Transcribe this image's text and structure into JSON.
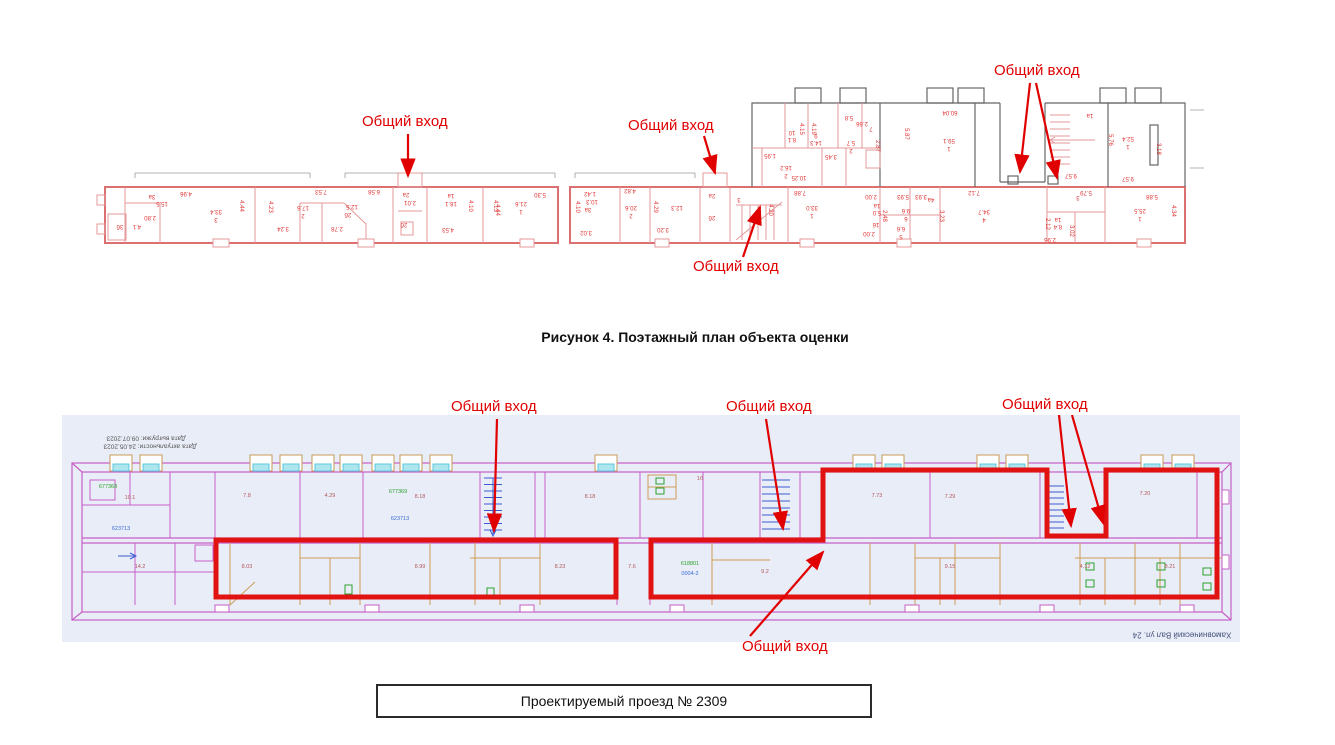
{
  "figure_caption": "Рисунок 4. Поэтажный план объекта оценки",
  "road_box": {
    "label": "Проектируемый проезд № 2309"
  },
  "colors": {
    "entrance_red": "#e00000",
    "highlight_red": "#e11212",
    "plan_pink": "#e49a9a",
    "plan_magenta": "#c75fc7",
    "partition_orange": "#cf9a55",
    "window_cyan": "#aee6f0",
    "stair_blue": "#3a5bd0",
    "bg_blue": "#e9edf8",
    "code_green": "#2ba12b",
    "code_blue": "#3a6bd6"
  },
  "top_plan": {
    "entrances": [
      {
        "text": "Общий вход",
        "x": 362,
        "y": 113,
        "arrows": [
          [
            408,
            134,
            408,
            176
          ]
        ]
      },
      {
        "text": "Общий вход",
        "x": 628,
        "y": 117,
        "arrows": [
          [
            704,
            136,
            715,
            173
          ]
        ]
      },
      {
        "text": "Общий вход",
        "x": 693,
        "y": 258,
        "arrows": [
          [
            743,
            257,
            760,
            207
          ]
        ]
      },
      {
        "text": "Общий вход",
        "x": 994,
        "y": 62,
        "arrows": [
          [
            1030,
            83,
            1020,
            172
          ],
          [
            1036,
            83,
            1057,
            178
          ]
        ]
      }
    ],
    "dim_labels": [
      {
        "t": "4.96",
        "x": 186,
        "y": 193
      },
      {
        "t": "3а",
        "x": 152,
        "y": 196
      },
      {
        "t": "15.5",
        "x": 162,
        "y": 203
      },
      {
        "t": "2.80",
        "x": 150,
        "y": 217
      },
      {
        "t": "4.1",
        "x": 137,
        "y": 226
      },
      {
        "t": "3б",
        "x": 120,
        "y": 226
      },
      {
        "t": "33.4",
        "x": 216,
        "y": 211
      },
      {
        "t": "3",
        "x": 216,
        "y": 219
      },
      {
        "t": "7.53",
        "x": 321,
        "y": 191
      },
      {
        "t": "4.44",
        "x": 241,
        "y": 206,
        "v": 1
      },
      {
        "t": "17.6",
        "x": 303,
        "y": 207
      },
      {
        "t": "2",
        "x": 303,
        "y": 215
      },
      {
        "t": "3.24",
        "x": 283,
        "y": 228
      },
      {
        "t": "2.78",
        "x": 337,
        "y": 228
      },
      {
        "t": "12.5",
        "x": 352,
        "y": 206
      },
      {
        "t": "2б",
        "x": 348,
        "y": 214
      },
      {
        "t": "6.58",
        "x": 374,
        "y": 191
      },
      {
        "t": "4.23",
        "x": 270,
        "y": 207,
        "v": 1
      },
      {
        "t": "4.44",
        "x": 497,
        "y": 210,
        "v": 1
      },
      {
        "t": "2а",
        "x": 406,
        "y": 194
      },
      {
        "t": "2.01",
        "x": 410,
        "y": 202
      },
      {
        "t": "2б",
        "x": 404,
        "y": 224
      },
      {
        "t": "1а",
        "x": 451,
        "y": 195
      },
      {
        "t": "18.1",
        "x": 451,
        "y": 203
      },
      {
        "t": "4.10",
        "x": 470,
        "y": 206,
        "v": 1
      },
      {
        "t": "4.53",
        "x": 448,
        "y": 229
      },
      {
        "t": "4.13",
        "x": 495,
        "y": 206,
        "v": 1
      },
      {
        "t": "21.6",
        "x": 521,
        "y": 203
      },
      {
        "t": "1",
        "x": 521,
        "y": 211
      },
      {
        "t": "5.30",
        "x": 540,
        "y": 194
      },
      {
        "t": "4.10",
        "x": 577,
        "y": 207,
        "v": 1
      },
      {
        "t": "1.42",
        "x": 590,
        "y": 193
      },
      {
        "t": "10.3",
        "x": 592,
        "y": 201
      },
      {
        "t": "3а",
        "x": 588,
        "y": 209
      },
      {
        "t": "3.02",
        "x": 586,
        "y": 232
      },
      {
        "t": "4.82",
        "x": 630,
        "y": 190
      },
      {
        "t": "20.6",
        "x": 631,
        "y": 207
      },
      {
        "t": "2",
        "x": 631,
        "y": 215
      },
      {
        "t": "4.29",
        "x": 655,
        "y": 207,
        "v": 1
      },
      {
        "t": "12.3",
        "x": 677,
        "y": 207
      },
      {
        "t": "3.20",
        "x": 663,
        "y": 229
      },
      {
        "t": "2а",
        "x": 712,
        "y": 195
      },
      {
        "t": "2б",
        "x": 712,
        "y": 217
      },
      {
        "t": "3",
        "x": 739,
        "y": 199
      },
      {
        "t": "7.88",
        "x": 800,
        "y": 192
      },
      {
        "t": "33.0",
        "x": 812,
        "y": 207
      },
      {
        "t": "1",
        "x": 812,
        "y": 215
      },
      {
        "t": "4.20",
        "x": 770,
        "y": 210,
        "v": 1
      },
      {
        "t": "2.00",
        "x": 871,
        "y": 196
      },
      {
        "t": "1а",
        "x": 877,
        "y": 205
      },
      {
        "t": "5.0",
        "x": 877,
        "y": 212
      },
      {
        "t": "16",
        "x": 876,
        "y": 224
      },
      {
        "t": "2.00",
        "x": 869,
        "y": 233
      },
      {
        "t": "5.93",
        "x": 903,
        "y": 196
      },
      {
        "t": "3.93",
        "x": 921,
        "y": 196
      },
      {
        "t": "4а",
        "x": 931,
        "y": 199
      },
      {
        "t": "2.48",
        "x": 884,
        "y": 216,
        "v": 1
      },
      {
        "t": "9.6",
        "x": 906,
        "y": 210
      },
      {
        "t": "6",
        "x": 906,
        "y": 218
      },
      {
        "t": "6.6",
        "x": 901,
        "y": 228
      },
      {
        "t": "5",
        "x": 901,
        "y": 236
      },
      {
        "t": "3.23",
        "x": 941,
        "y": 216,
        "v": 1
      },
      {
        "t": "7.12",
        "x": 974,
        "y": 192
      },
      {
        "t": "34.7",
        "x": 984,
        "y": 211
      },
      {
        "t": "4",
        "x": 984,
        "y": 219
      },
      {
        "t": "2.12",
        "x": 1047,
        "y": 224,
        "v": 1
      },
      {
        "t": "3",
        "x": 1078,
        "y": 197
      },
      {
        "t": "5.79",
        "x": 1086,
        "y": 192
      },
      {
        "t": "1а",
        "x": 1058,
        "y": 219
      },
      {
        "t": "8.4",
        "x": 1058,
        "y": 226
      },
      {
        "t": "3.02",
        "x": 1071,
        "y": 231,
        "v": 1
      },
      {
        "t": "2.96",
        "x": 1050,
        "y": 239
      },
      {
        "t": "5.88",
        "x": 1152,
        "y": 196
      },
      {
        "t": "25.5",
        "x": 1140,
        "y": 210
      },
      {
        "t": "1",
        "x": 1140,
        "y": 218
      },
      {
        "t": "4.34",
        "x": 1173,
        "y": 211,
        "v": 1
      },
      {
        "t": "1.95",
        "x": 770,
        "y": 155
      },
      {
        "t": "16.2",
        "x": 786,
        "y": 167
      },
      {
        "t": "2",
        "x": 786,
        "y": 175
      },
      {
        "t": "10.25",
        "x": 799,
        "y": 177
      },
      {
        "t": "10",
        "x": 792,
        "y": 132
      },
      {
        "t": "8.1",
        "x": 792,
        "y": 139
      },
      {
        "t": "9",
        "x": 816,
        "y": 135
      },
      {
        "t": "14.3",
        "x": 816,
        "y": 142
      },
      {
        "t": "4.15",
        "x": 801,
        "y": 129,
        "v": 1
      },
      {
        "t": "4.19",
        "x": 813,
        "y": 129,
        "v": 1
      },
      {
        "t": "3.45",
        "x": 831,
        "y": 156
      },
      {
        "t": "5.8",
        "x": 849,
        "y": 117
      },
      {
        "t": "2.66",
        "x": 862,
        "y": 123
      },
      {
        "t": "7",
        "x": 871,
        "y": 128
      },
      {
        "t": "5.7",
        "x": 851,
        "y": 142
      },
      {
        "t": "2",
        "x": 851,
        "y": 150
      },
      {
        "t": "2.87",
        "x": 877,
        "y": 146,
        "v": 1
      },
      {
        "t": "5.87",
        "x": 906,
        "y": 134,
        "v": 1
      },
      {
        "t": "60.04",
        "x": 950,
        "y": 112
      },
      {
        "t": "59.1",
        "x": 949,
        "y": 140
      },
      {
        "t": "1",
        "x": 949,
        "y": 148
      },
      {
        "t": "9.57",
        "x": 1071,
        "y": 175
      },
      {
        "t": "1а",
        "x": 1090,
        "y": 115
      },
      {
        "t": "5.76",
        "x": 1110,
        "y": 140,
        "v": 1
      },
      {
        "t": "52.4",
        "x": 1128,
        "y": 138
      },
      {
        "t": "1",
        "x": 1128,
        "y": 146
      },
      {
        "t": "3.18",
        "x": 1158,
        "y": 149,
        "v": 1
      },
      {
        "t": "9.57",
        "x": 1128,
        "y": 178
      }
    ]
  },
  "bottom_plan": {
    "entrances": [
      {
        "text": "Общий вход",
        "x": 451,
        "y": 398,
        "arrows": [
          [
            497,
            419,
            494,
            531
          ]
        ]
      },
      {
        "text": "Общий вход",
        "x": 726,
        "y": 398,
        "arrows": [
          [
            766,
            419,
            783,
            529
          ]
        ]
      },
      {
        "text": "Общий вход",
        "x": 1002,
        "y": 396,
        "arrows": [
          [
            1059,
            415,
            1071,
            526
          ],
          [
            1072,
            415,
            1103,
            523
          ]
        ]
      },
      {
        "text": "Общий вход",
        "x": 742,
        "y": 638,
        "arrows": [
          [
            750,
            636,
            823,
            552
          ]
        ]
      }
    ],
    "window_x": [
      110,
      140,
      250,
      280,
      312,
      340,
      372,
      400,
      430,
      595,
      853,
      882,
      977,
      1006,
      1141,
      1172
    ],
    "labels": [
      {
        "t": "677368",
        "x": 108,
        "y": 487,
        "c": "#2ba12b",
        "n": "code-label"
      },
      {
        "t": "623713",
        "x": 121,
        "y": 529,
        "c": "#3a6bd6",
        "n": "code-label"
      },
      {
        "t": "677369",
        "x": 398,
        "y": 492,
        "c": "#2ba12b",
        "n": "code-label"
      },
      {
        "t": "623713",
        "x": 400,
        "y": 519,
        "c": "#3a6bd6",
        "n": "code-label"
      },
      {
        "t": "618801",
        "x": 690,
        "y": 564,
        "c": "#2ba12b",
        "n": "code-label"
      },
      {
        "t": "0004-2",
        "x": 690,
        "y": 574,
        "c": "#3a6bd6",
        "n": "code-label"
      },
      {
        "t": "10.1",
        "x": 130,
        "y": 498
      },
      {
        "t": "7.8",
        "x": 247,
        "y": 496
      },
      {
        "t": "4.29",
        "x": 330,
        "y": 496
      },
      {
        "t": "8.18",
        "x": 420,
        "y": 497
      },
      {
        "t": "8.18",
        "x": 590,
        "y": 497
      },
      {
        "t": "1б",
        "x": 700,
        "y": 479
      },
      {
        "t": "7.73",
        "x": 877,
        "y": 496
      },
      {
        "t": "7.29",
        "x": 950,
        "y": 497
      },
      {
        "t": "7.20",
        "x": 1145,
        "y": 494
      },
      {
        "t": "14.2",
        "x": 140,
        "y": 567
      },
      {
        "t": "8.03",
        "x": 247,
        "y": 567
      },
      {
        "t": "8.99",
        "x": 420,
        "y": 567
      },
      {
        "t": "8.23",
        "x": 560,
        "y": 567
      },
      {
        "t": "7.6",
        "x": 632,
        "y": 567
      },
      {
        "t": "9.2",
        "x": 765,
        "y": 572
      },
      {
        "t": "9.15",
        "x": 950,
        "y": 567
      },
      {
        "t": "4.12",
        "x": 1085,
        "y": 567
      },
      {
        "t": "8.21",
        "x": 1170,
        "y": 567
      },
      {
        "t": "Дата выгрузки: 09.07.2023",
        "x": 146,
        "y": 438,
        "f": 1,
        "c": "#555555",
        "n": "date-label"
      },
      {
        "t": "Дата актуальности: 24.05.2023",
        "x": 150,
        "y": 446,
        "f": 1,
        "c": "#555555",
        "n": "date-label"
      },
      {
        "t": "Хамовнический Вал ул. 24",
        "x": 1182,
        "y": 634,
        "f": 1,
        "c": "#44507a",
        "s": 8,
        "n": "address-label"
      }
    ]
  }
}
